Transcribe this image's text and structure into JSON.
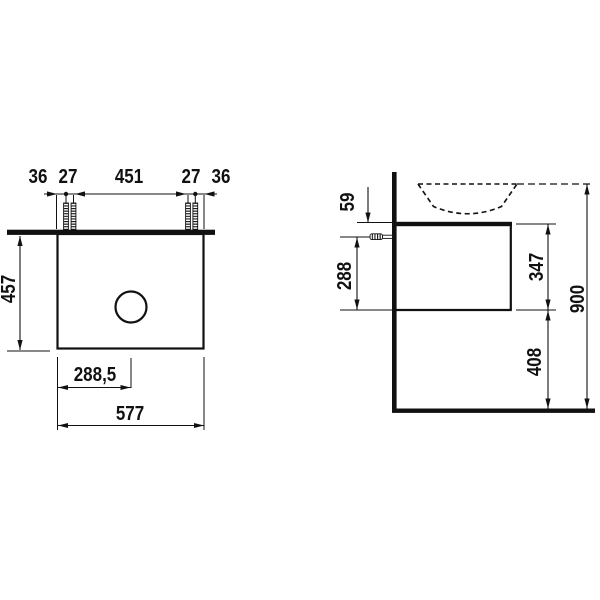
{
  "front_view": {
    "top_dims": [
      "36",
      "27",
      "451",
      "27",
      "36"
    ],
    "height": "457",
    "basin_center": "288,5",
    "width": "577"
  },
  "side_view": {
    "top_offset": "59",
    "fixing_height": "288",
    "body_height": "347",
    "clearance": "408",
    "total_height": "900"
  },
  "colors": {
    "line": "#111111",
    "background": "#ffffff"
  }
}
